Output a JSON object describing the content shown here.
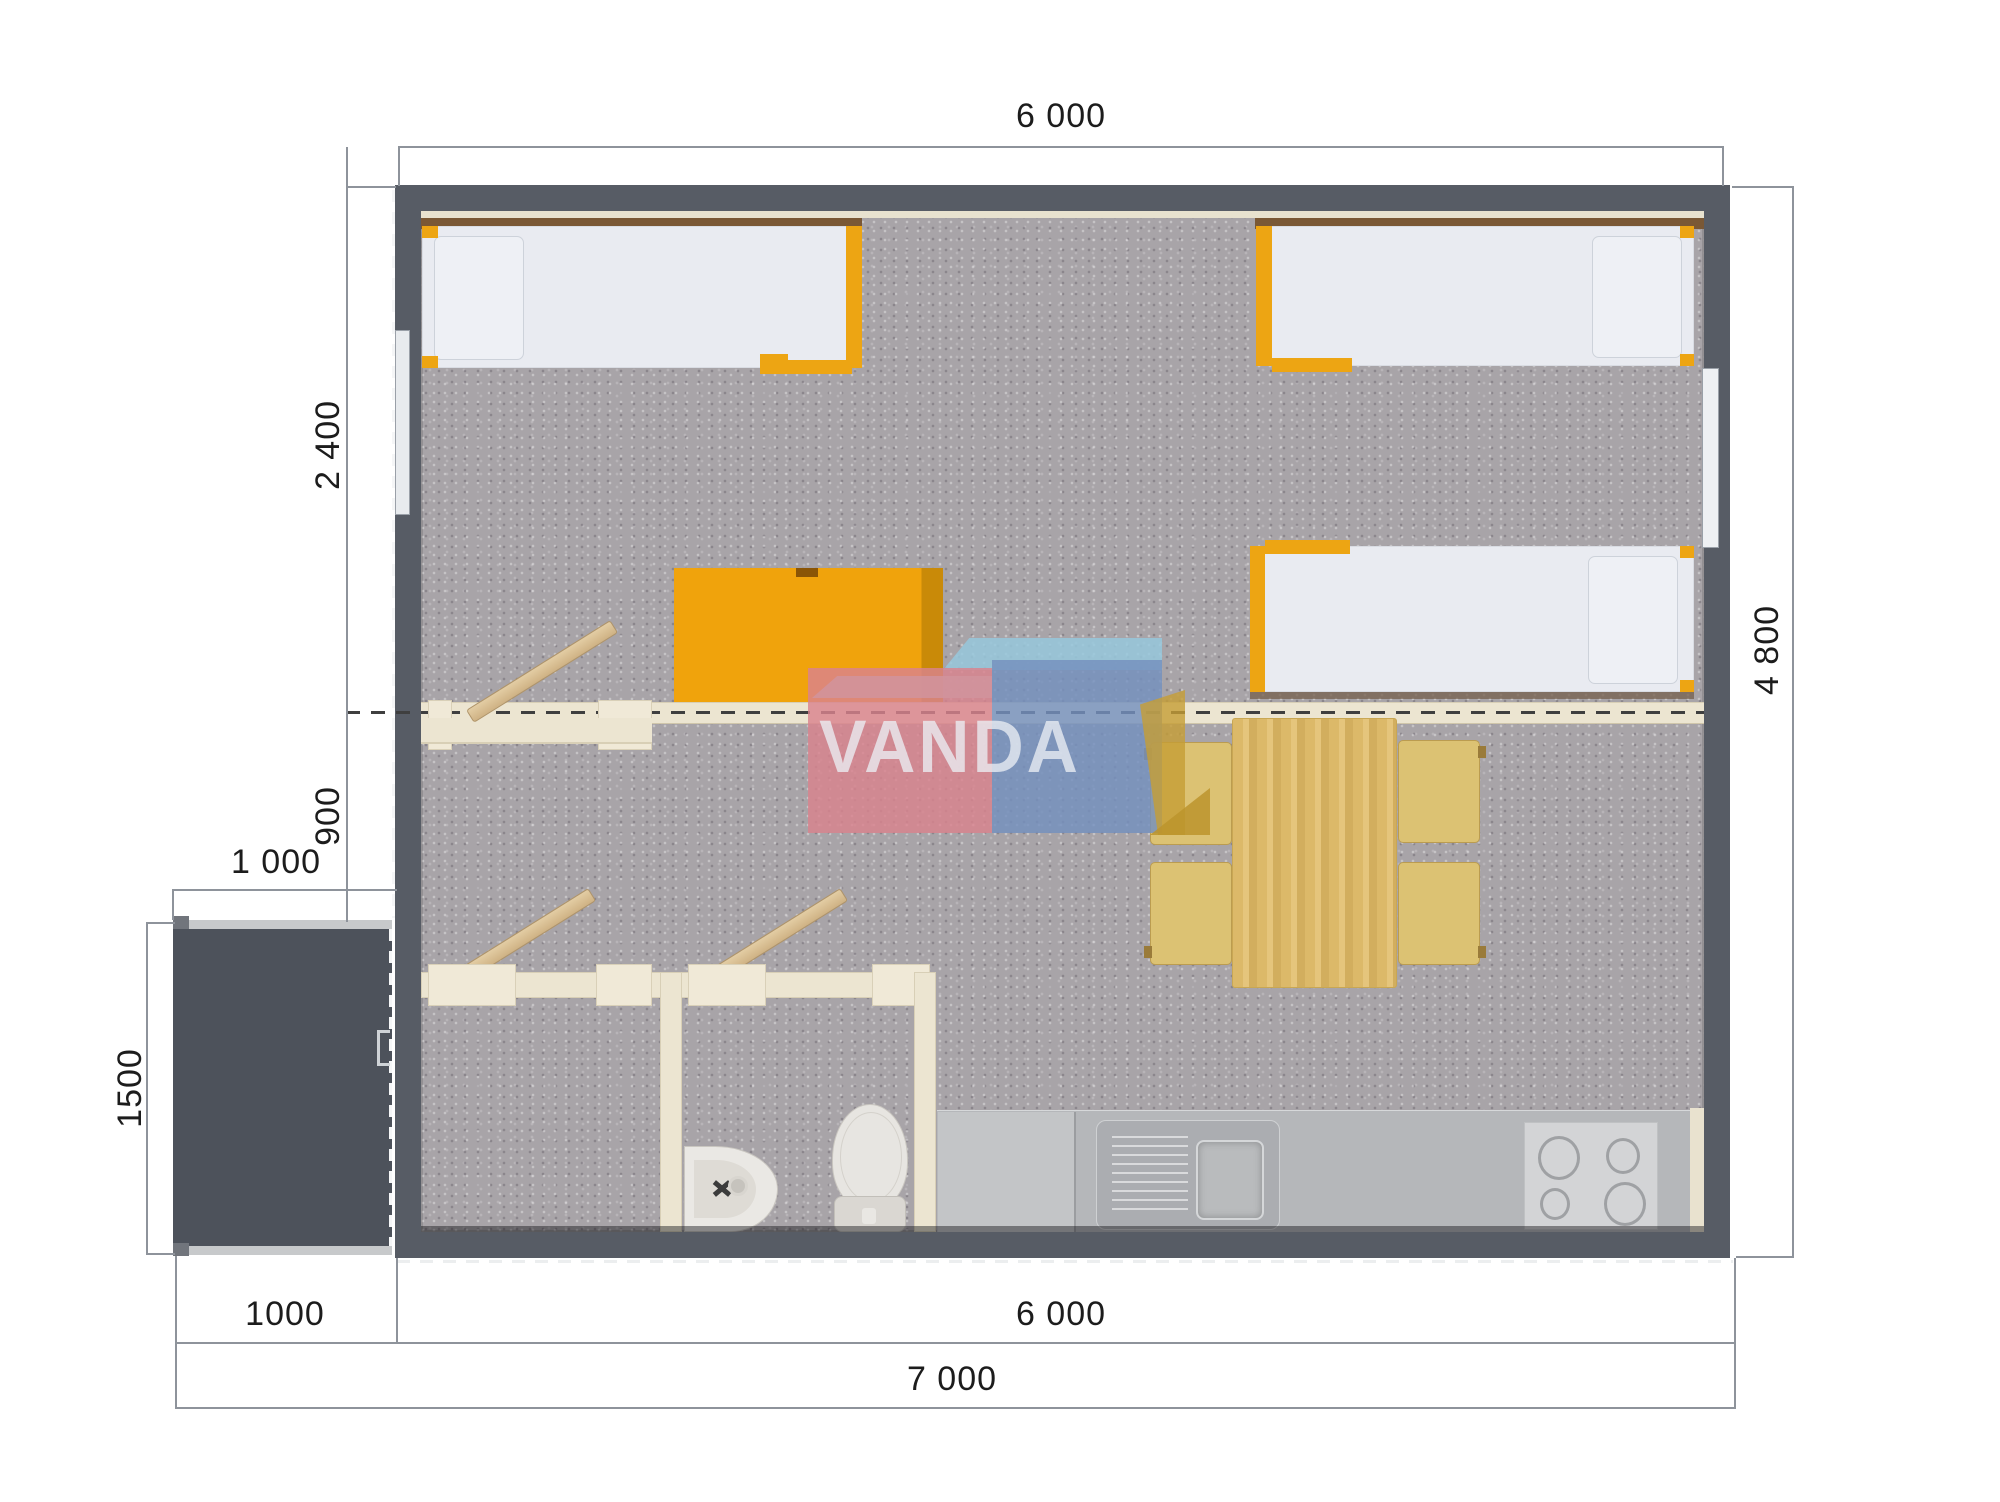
{
  "page": {
    "title": "VANDA cabin floor plan",
    "type": "architectural-top-view"
  },
  "dimensions": {
    "top_width": "6 000",
    "right_height": "4 800",
    "left_bedroom_depth": "2 400",
    "left_living_strip": "900",
    "porch_width_top": "1 000",
    "porch_depth": "1500",
    "bottom_porch_width": "1000",
    "bottom_building_width": "6 000",
    "bottom_total_width": "7 000"
  },
  "watermark": {
    "text": "VANDA"
  },
  "plan": {
    "furniture": [
      "bed-top-left",
      "bed-top-right",
      "bed-middle-right",
      "orange-desk",
      "bench-backrest-boards",
      "dining-table",
      "chair-x4",
      "bathroom-sink",
      "toilet",
      "kitchen-counter",
      "kitchen-sink-unit",
      "stove-4-burners",
      "entry-porch",
      "entry-door-handle",
      "window-left-wall",
      "window-right-wall"
    ]
  },
  "colors": {
    "wall": "#575c65",
    "porch": "#4d525b",
    "carpet": "#a8a4a8",
    "partition_cream": "#ece5d1",
    "accent_orange": "#eda513",
    "pine_wood": "#ddb969",
    "chair_tan": "#dcc273",
    "counter_gray": "#b5b7ba",
    "watermark_pink": "#d9828e",
    "watermark_blue": "#7490be",
    "dimension_text": "#1c1c1c"
  }
}
